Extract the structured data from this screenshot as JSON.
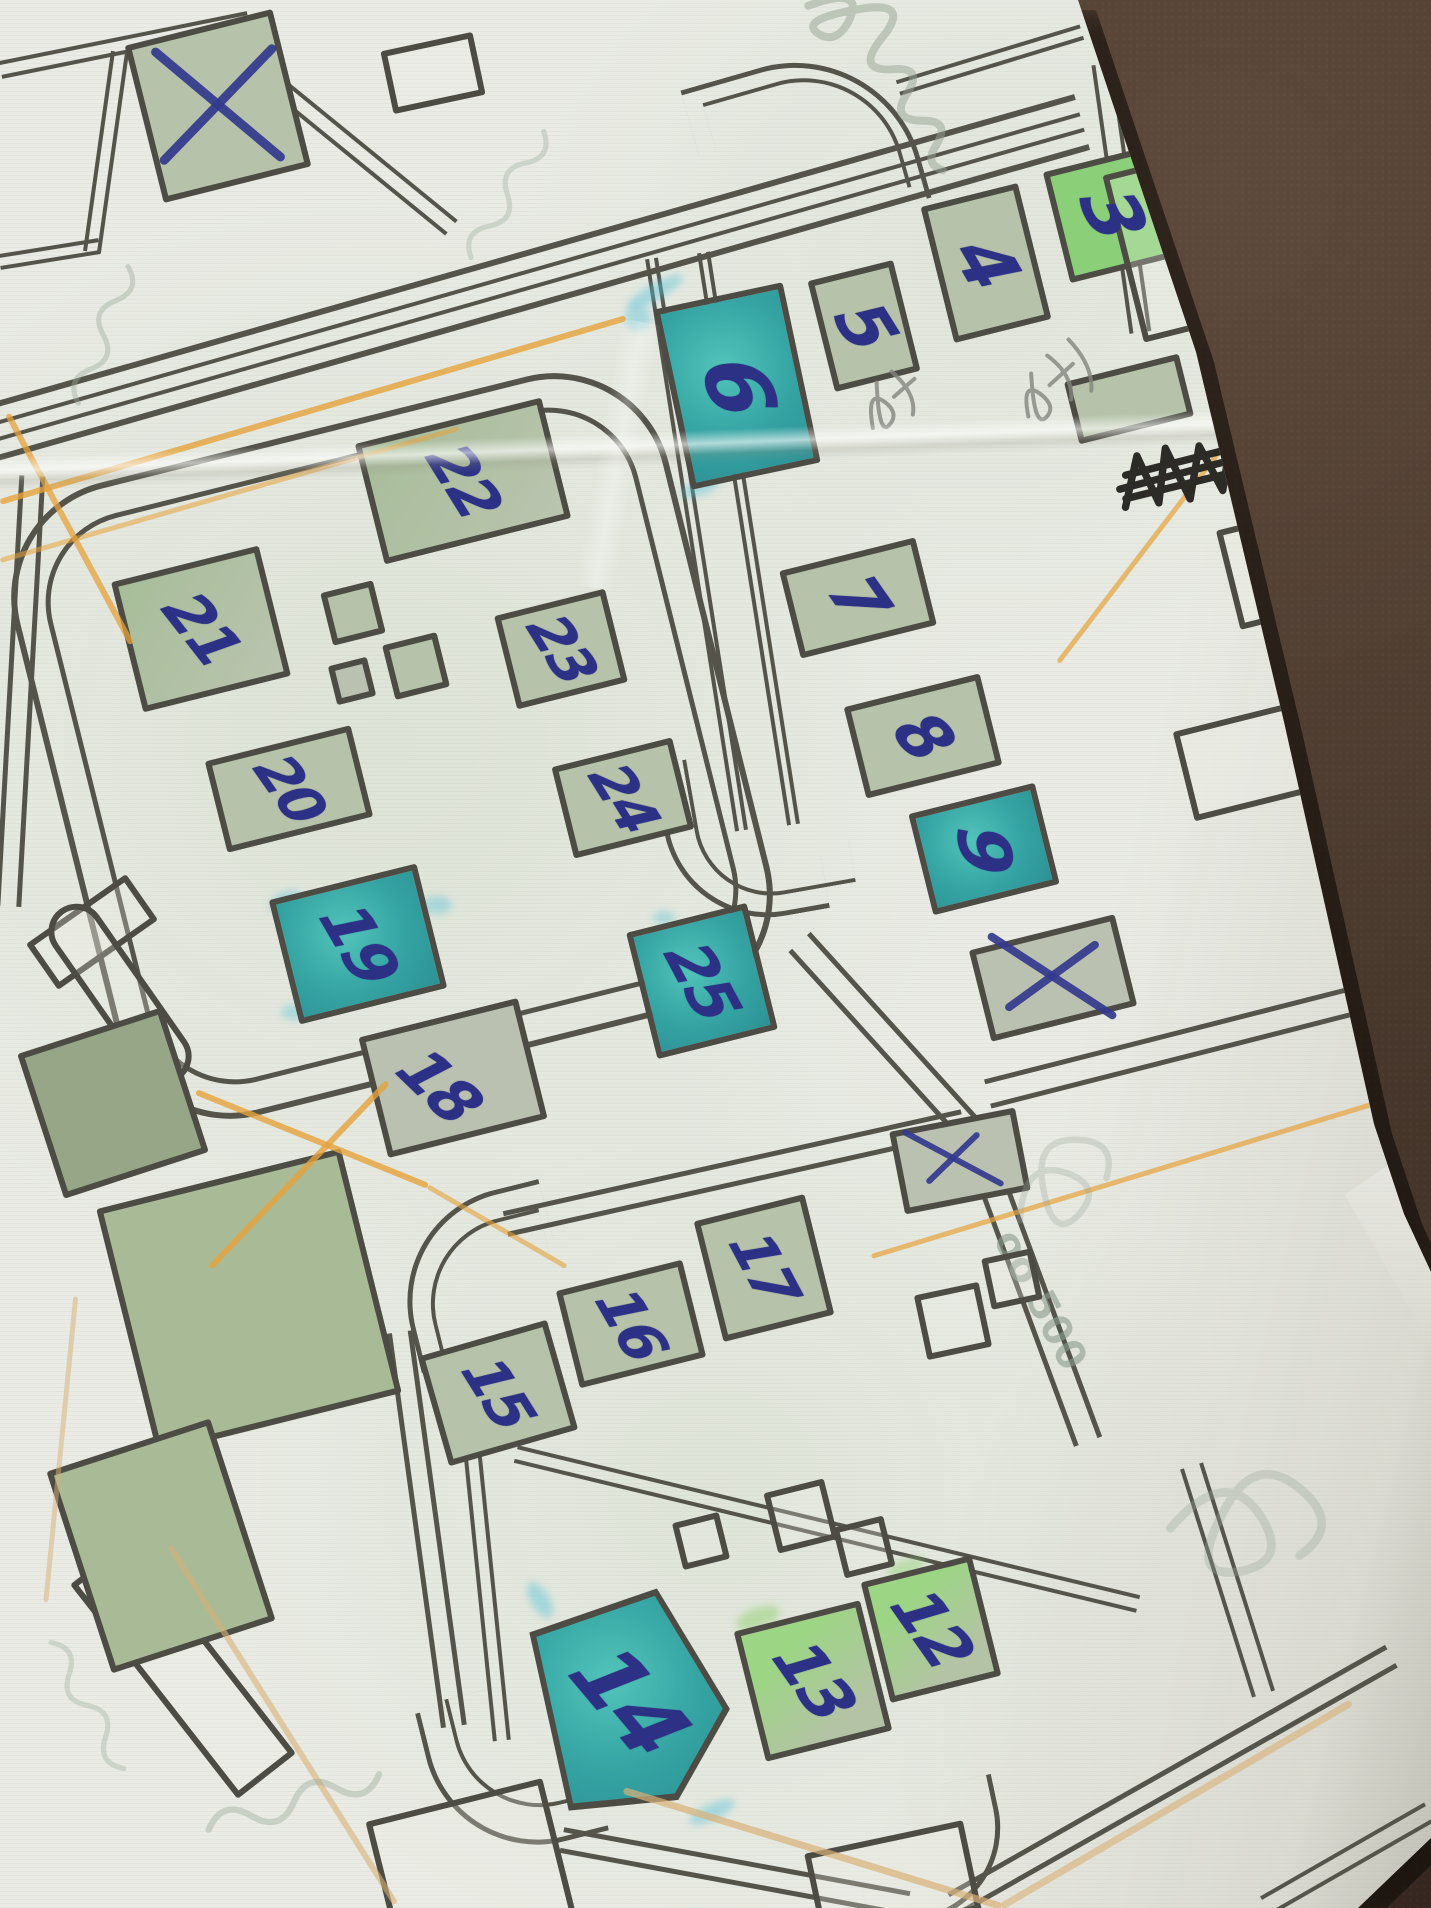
{
  "photo": {
    "description": "Photograph of a folded paper street map annotated by hand: blue ballpoint numbers 3-25 on buildings, blue X cross-outs, orange pencil route lines, teal and green highlighter fills, lying on a dark brown leather surface",
    "surface_color": "#4a392d",
    "paper_color": "#e9ebe4"
  },
  "palette": {
    "road": "#54544b",
    "building_outline": "#4c4c44",
    "pen": "#333a8d",
    "ink_black": "#22211e",
    "pencil": "#85857f",
    "orange": "#e5a23c",
    "tan": "#d8b077",
    "cyan_highlight": "#56c3d9",
    "green_highlight": "#8ed06f"
  },
  "annotations": {
    "visible_numbers": [
      "3",
      "4",
      "5",
      "6",
      "7",
      "8",
      "9",
      "12",
      "13",
      "14",
      "15",
      "16",
      "17",
      "18",
      "19",
      "20",
      "21",
      "22",
      "23",
      "24",
      "25"
    ],
    "x_mark_count": 4,
    "crossed_out_ink_scribble": "illegible word scribbled out in black ink",
    "pencil_notes": "two small illegible pencil scribbles near buildings 4 and 5",
    "faint_print_label": "oo 500"
  },
  "buildings": [
    {
      "id": "crossed-square-topleft",
      "label": "",
      "x": 218,
      "y": 106,
      "w": 152,
      "h": 162,
      "rot": -14,
      "fill": "sage"
    },
    {
      "id": "b3",
      "label": "3",
      "x": 1112,
      "y": 214,
      "w": 114,
      "h": 114,
      "rot": -14,
      "fill": "bright",
      "ls": 74,
      "lr": 66
    },
    {
      "id": "b4",
      "label": "4",
      "x": 986,
      "y": 263,
      "w": 100,
      "h": 140,
      "rot": -14,
      "fill": "sage",
      "ls": 72,
      "lr": 60
    },
    {
      "id": "b5",
      "label": "5",
      "x": 864,
      "y": 326,
      "w": 88,
      "h": 114,
      "rot": -14,
      "fill": "sage",
      "ls": 68,
      "lr": 58
    },
    {
      "id": "b6",
      "label": "6",
      "x": 737,
      "y": 386,
      "w": 132,
      "h": 184,
      "rot": -12,
      "fill": "teal",
      "ls": 86,
      "lr": 72
    },
    {
      "id": "b7",
      "label": "7",
      "x": 858,
      "y": 598,
      "w": 140,
      "h": 90,
      "rot": -14,
      "fill": "sage",
      "ls": 66,
      "lr": 55
    },
    {
      "id": "b8",
      "label": "8",
      "x": 923,
      "y": 736,
      "w": 140,
      "h": 94,
      "rot": -14,
      "fill": "sage",
      "ls": 66,
      "lr": 50
    },
    {
      "id": "b9",
      "label": "9",
      "x": 984,
      "y": 849,
      "w": 130,
      "h": 104,
      "rot": -14,
      "fill": "teal",
      "ls": 70,
      "lr": 82
    },
    {
      "id": "crossed-building",
      "label": "",
      "x": 1053,
      "y": 978,
      "w": 150,
      "h": 94,
      "rot": -14,
      "fill": "sagegrey"
    },
    {
      "id": "small-crossed-square",
      "label": "",
      "x": 960,
      "y": 1161,
      "w": 128,
      "h": 84,
      "rot": -11,
      "fill": "sagegrey"
    },
    {
      "id": "b22",
      "label": "22",
      "x": 463,
      "y": 481,
      "w": 192,
      "h": 124,
      "rot": -14,
      "fill": "sage2",
      "ls": 60,
      "lr": 58
    },
    {
      "id": "b21",
      "label": "21",
      "x": 201,
      "y": 629,
      "w": 152,
      "h": 134,
      "rot": -14,
      "fill": "sage2",
      "ls": 60,
      "lr": 52
    },
    {
      "id": "b23",
      "label": "23",
      "x": 561,
      "y": 649,
      "w": 114,
      "h": 96,
      "rot": -14,
      "fill": "sage",
      "ls": 56,
      "lr": 58
    },
    {
      "id": "b20",
      "label": "20",
      "x": 289,
      "y": 789,
      "w": 150,
      "h": 94,
      "rot": -14,
      "fill": "sage",
      "ls": 56,
      "lr": 55
    },
    {
      "id": "b24",
      "label": "24",
      "x": 623,
      "y": 798,
      "w": 124,
      "h": 94,
      "rot": -14,
      "fill": "sage",
      "ls": 56,
      "lr": 58
    },
    {
      "id": "b19",
      "label": "19",
      "x": 358,
      "y": 944,
      "w": 152,
      "h": 128,
      "rot": -14,
      "fill": "teal",
      "ls": 64,
      "lr": 60
    },
    {
      "id": "b25",
      "label": "25",
      "x": 702,
      "y": 981,
      "w": 124,
      "h": 130,
      "rot": -14,
      "fill": "teal",
      "ls": 62,
      "lr": 62
    },
    {
      "id": "b18",
      "label": "18",
      "x": 453,
      "y": 1078,
      "w": 164,
      "h": 124,
      "rot": -14,
      "fill": "sagegrey",
      "ls": 62,
      "lr": 44,
      "dx": -14,
      "dy": 8
    },
    {
      "id": "b17",
      "label": "17",
      "x": 764,
      "y": 1268,
      "w": 114,
      "h": 124,
      "rot": -14,
      "fill": "sage",
      "ls": 58,
      "lr": 62
    },
    {
      "id": "b16",
      "label": "16",
      "x": 631,
      "y": 1324,
      "w": 130,
      "h": 100,
      "rot": -14,
      "fill": "sage",
      "ls": 58,
      "lr": 60
    },
    {
      "id": "b15",
      "label": "15",
      "x": 498,
      "y": 1393,
      "w": 134,
      "h": 114,
      "rot": -16,
      "fill": "sage",
      "ls": 58,
      "lr": 58
    },
    {
      "id": "b14",
      "label": "14",
      "x": 629,
      "y": 1701,
      "w": 196,
      "h": 212,
      "rot": -10,
      "fill": "teal",
      "ls": 88,
      "lr": 50,
      "shape": "pent"
    },
    {
      "id": "b13",
      "label": "13",
      "x": 813,
      "y": 1681,
      "w": 130,
      "h": 134,
      "rot": -14,
      "fill": "bright2",
      "ls": 64,
      "lr": 55
    },
    {
      "id": "b12",
      "label": "12",
      "x": 931,
      "y": 1629,
      "w": 114,
      "h": 124,
      "rot": -14,
      "fill": "bright2",
      "ls": 64,
      "lr": 55
    },
    {
      "id": "sq1",
      "label": "",
      "x": 353,
      "y": 613,
      "w": 54,
      "h": 54,
      "rot": -14,
      "fill": "sage"
    },
    {
      "id": "sq2",
      "label": "",
      "x": 416,
      "y": 666,
      "w": 56,
      "h": 56,
      "rot": -14,
      "fill": "sage"
    },
    {
      "id": "sq3",
      "label": "",
      "x": 352,
      "y": 681,
      "w": 40,
      "h": 40,
      "rot": -14,
      "fill": "sagegrey"
    },
    {
      "id": "sq4",
      "label": "",
      "x": 1129,
      "y": 399,
      "w": 118,
      "h": 64,
      "rot": -14,
      "fill": "sage"
    },
    {
      "id": "w1",
      "label": "",
      "x": 1196,
      "y": 241,
      "w": 150,
      "h": 172,
      "rot": -14,
      "fill": "none"
    },
    {
      "id": "w2",
      "label": "",
      "x": 1302,
      "y": 562,
      "w": 152,
      "h": 102,
      "rot": -14,
      "fill": "none"
    },
    {
      "id": "w3",
      "label": "",
      "x": 1243,
      "y": 762,
      "w": 122,
      "h": 92,
      "rot": -14,
      "fill": "none"
    },
    {
      "id": "w4",
      "label": "",
      "x": 433,
      "y": 73,
      "w": 94,
      "h": 64,
      "rot": -12,
      "fill": "none"
    },
    {
      "id": "w5",
      "label": "",
      "x": 953,
      "y": 1321,
      "w": 66,
      "h": 66,
      "rot": -12,
      "fill": "none"
    },
    {
      "id": "w6",
      "label": "",
      "x": 1012,
      "y": 1279,
      "w": 52,
      "h": 52,
      "rot": -12,
      "fill": "none"
    },
    {
      "id": "w7",
      "label": "",
      "x": 801,
      "y": 1516,
      "w": 62,
      "h": 62,
      "rot": -14,
      "fill": "none"
    },
    {
      "id": "w8",
      "label": "",
      "x": 864,
      "y": 1547,
      "w": 52,
      "h": 52,
      "rot": -14,
      "fill": "none"
    },
    {
      "id": "w9",
      "label": "",
      "x": 701,
      "y": 1541,
      "w": 48,
      "h": 48,
      "rot": -14,
      "fill": "none"
    },
    {
      "id": "w10",
      "label": "",
      "x": 183,
      "y": 1669,
      "w": 272,
      "h": 74,
      "rot": 52,
      "fill": "none"
    },
    {
      "id": "w11",
      "label": "",
      "x": 471,
      "y": 1869,
      "w": 182,
      "h": 142,
      "rot": -14,
      "fill": "none"
    },
    {
      "id": "w12",
      "label": "",
      "x": 893,
      "y": 1882,
      "w": 162,
      "h": 92,
      "rot": -12,
      "fill": "none"
    },
    {
      "id": "w13",
      "label": "",
      "x": 92,
      "y": 932,
      "w": 122,
      "h": 56,
      "rot": -35,
      "fill": "none"
    },
    {
      "id": "w14",
      "label": "",
      "x": 120,
      "y": 994,
      "w": 208,
      "h": 56,
      "rot": 55,
      "fill": "none",
      "rounded": true
    },
    {
      "id": "park-diamond",
      "label": "",
      "x": 249,
      "y": 1301,
      "w": 252,
      "h": 252,
      "rot": -14,
      "fill": "park"
    },
    {
      "id": "park-trapezoid",
      "label": "",
      "x": 161,
      "y": 1546,
      "w": 172,
      "h": 212,
      "rot": -18,
      "fill": "park"
    },
    {
      "id": "green-block",
      "label": "",
      "x": 113,
      "y": 1103,
      "w": 152,
      "h": 152,
      "rot": -18,
      "fill": "sagedark"
    }
  ],
  "park_circle": [
    272,
    1288,
    134
  ],
  "roads": {
    "rings": [
      [
        392,
        746,
        674,
        652,
        118,
        -14,
        6
      ],
      [
        392,
        746,
        608,
        586,
        92,
        -14,
        5
      ]
    ],
    "segments": [
      [
        -20,
        436,
        1082,
        122,
        58,
        6
      ],
      [
        -20,
        436,
        1082,
        122,
        20,
        4
      ],
      [
        0,
        70,
        248,
        20,
        18,
        4
      ],
      [
        120,
        52,
        92,
        252,
        18,
        4
      ],
      [
        268,
        78,
        452,
        228,
        20,
        4
      ],
      [
        0,
        262,
        100,
        246,
        16,
        4
      ],
      [
        652,
        258,
        742,
        830,
        13,
        4
      ],
      [
        704,
        252,
        794,
        824,
        13,
        4
      ],
      [
        800,
        942,
        974,
        1134,
        30,
        5
      ],
      [
        974,
        1134,
        1088,
        1442,
        30,
        5
      ],
      [
        988,
        1094,
        1350,
        1002,
        30,
        5
      ],
      [
        32,
        476,
        8,
        906,
        26,
        5
      ],
      [
        506,
        1224,
        964,
        1122,
        26,
        5
      ],
      [
        400,
        1332,
        454,
        1726,
        26,
        5
      ],
      [
        562,
        1840,
        908,
        1904,
        26,
        5
      ],
      [
        472,
        1446,
        502,
        1740,
        18,
        4
      ],
      [
        516,
        1454,
        1138,
        1604,
        18,
        4
      ],
      [
        954,
        1904,
        1392,
        1656,
        26,
        5
      ],
      [
        1266,
        1906,
        1430,
        1812,
        22,
        4
      ],
      [
        1102,
        64,
        1140,
        332,
        22,
        4
      ],
      [
        1150,
        36,
        1264,
        10,
        18,
        4
      ],
      [
        1192,
        1466,
        1264,
        1694,
        24,
        4
      ],
      [
        898,
        88,
        1082,
        32,
        16,
        4
      ]
    ],
    "arcs": [
      [
        700,
        58,
        212,
        172,
        -16,
        "tr",
        130,
        5
      ],
      [
        718,
        76,
        178,
        138,
        -16,
        "tr",
        102,
        4
      ],
      [
        668,
        772,
        150,
        150,
        -10,
        "bl",
        105,
        5
      ],
      [
        694,
        746,
        150,
        150,
        -10,
        "bl",
        78,
        4
      ],
      [
        400,
        1196,
        160,
        160,
        -14,
        "tl",
        115,
        5
      ],
      [
        426,
        1222,
        130,
        130,
        -14,
        "tl",
        88,
        4
      ],
      [
        432,
        1692,
        160,
        160,
        -14,
        "bl",
        115,
        5
      ],
      [
        458,
        1682,
        130,
        130,
        -14,
        "bl",
        88,
        4
      ],
      [
        856,
        1788,
        150,
        130,
        -12,
        "br",
        95,
        5
      ]
    ]
  },
  "orange_lines": [
    [
      0,
      502,
      626,
      318,
      6,
      "o",
      0.8
    ],
    [
      0,
      560,
      458,
      428,
      5,
      "o",
      0.55
    ],
    [
      8,
      414,
      132,
      644,
      6,
      "o",
      0.75
    ],
    [
      196,
      1092,
      428,
      1186,
      6,
      "o",
      0.8
    ],
    [
      388,
      1082,
      210,
      1268,
      6,
      "o",
      0.8
    ],
    [
      428,
      1186,
      566,
      1266,
      5,
      "o",
      0.6
    ],
    [
      1058,
      662,
      1272,
      382,
      5,
      "o",
      0.7
    ],
    [
      872,
      1256,
      1431,
      1086,
      5,
      "o",
      0.7
    ],
    [
      624,
      1790,
      1002,
      1906,
      7,
      "t",
      0.7
    ],
    [
      1002,
      1906,
      1352,
      1702,
      7,
      "t",
      0.6
    ],
    [
      170,
      1546,
      396,
      1904,
      6,
      "t",
      0.6
    ],
    [
      76,
      1296,
      46,
      1602,
      5,
      "t",
      0.5
    ]
  ],
  "x_strokes": [
    [
      218,
      104,
      172,
      40,
      9
    ],
    [
      218,
      104,
      164,
      -46,
      9
    ],
    [
      1330,
      266,
      176,
      48,
      7
    ],
    [
      1330,
      266,
      152,
      -52,
      7
    ],
    [
      1052,
      976,
      152,
      33,
      8
    ],
    [
      1052,
      976,
      114,
      -36,
      8
    ],
    [
      953,
      1158,
      114,
      28,
      6
    ],
    [
      953,
      1158,
      72,
      -44,
      6
    ]
  ],
  "scribbles": [
    [
      "dense",
      1186,
      472,
      -11,
      1.05,
      "#22211e",
      7,
      0.95
    ],
    [
      "mark2",
      1316,
      282,
      -8,
      1.0,
      "#2a2a30",
      6,
      0.9
    ],
    [
      "loops",
      898,
      396,
      -24,
      1.0,
      "#85857f",
      4,
      0.8
    ],
    [
      "loops2",
      1064,
      376,
      -24,
      1.0,
      "#85857f",
      4,
      0.8
    ],
    [
      "cursive",
      900,
      88,
      55,
      2.0,
      "#97a594",
      4,
      0.5
    ],
    [
      "wavy",
      105,
      330,
      -70,
      1.3,
      "#9aaa98",
      4,
      0.4
    ],
    [
      "wavy",
      510,
      190,
      -60,
      1.3,
      "#9aaa98",
      4,
      0.35
    ],
    [
      "wavy",
      1330,
      770,
      75,
      1.6,
      "#9aaa98",
      4,
      0.4
    ],
    [
      "wavy",
      300,
      1800,
      -18,
      1.6,
      "#9aaa98",
      4,
      0.4
    ],
    [
      "wavy",
      90,
      1710,
      60,
      1.3,
      "#9aaa98",
      4,
      0.35
    ],
    [
      "curl",
      1250,
      1520,
      10,
      2.2,
      "#9aa79a",
      4,
      0.32
    ],
    [
      "curl",
      1062,
      1180,
      -28,
      1.6,
      "#9aa79a",
      4,
      0.3
    ]
  ],
  "highlights": [
    [
      655,
      292,
      64,
      16,
      -30,
      "c",
      0.45
    ],
    [
      638,
      318,
      26,
      26,
      0,
      "c",
      0.4
    ],
    [
      700,
      488,
      40,
      14,
      -20,
      "c",
      0.45
    ],
    [
      286,
      902,
      34,
      20,
      -20,
      "c",
      0.45
    ],
    [
      437,
      905,
      30,
      18,
      0,
      "c",
      0.4
    ],
    [
      296,
      1012,
      30,
      16,
      0,
      "c",
      0.4
    ],
    [
      540,
      1600,
      40,
      18,
      60,
      "c",
      0.45
    ],
    [
      712,
      1812,
      50,
      16,
      -25,
      "c",
      0.45
    ],
    [
      664,
      918,
      22,
      14,
      0,
      "c",
      0.4
    ],
    [
      758,
      1618,
      46,
      20,
      -20,
      "g",
      0.5
    ],
    [
      906,
      1568,
      40,
      18,
      -20,
      "g",
      0.45
    ],
    [
      590,
      1640,
      30,
      30,
      0,
      "c",
      0.35
    ]
  ],
  "faint_label": {
    "text": "oo 500",
    "x": 1040,
    "y": 1300,
    "rot": 62,
    "size": 40
  }
}
